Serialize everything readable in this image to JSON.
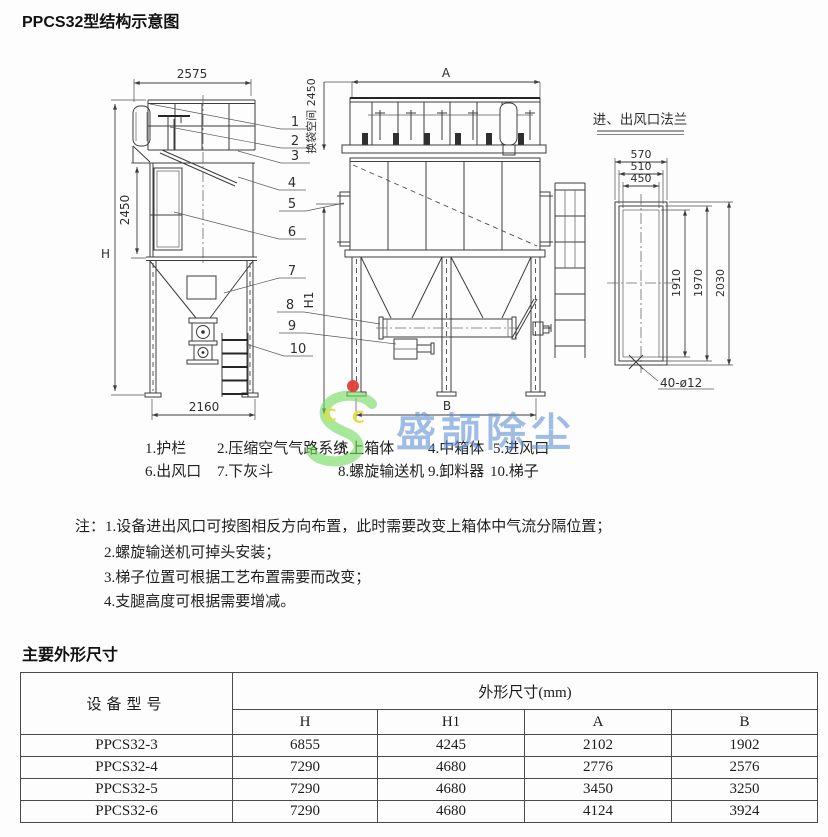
{
  "page": {
    "title": "PPCS32型结构示意图",
    "section2_title": "主要外形尺寸"
  },
  "diagram": {
    "side_view": {
      "dim_top_width": "2575",
      "dim_height": "H",
      "dim_body_height": "2450",
      "dim_bottom_width": "2160"
    },
    "front_view": {
      "dim_top_width": "A",
      "dim_bag_space": "换袋空间 2450",
      "dim_inlet_height": "H1",
      "dim_bottom_width": "B"
    },
    "flange_view": {
      "title": "进、出风口法兰",
      "dim_w_outer": "570",
      "dim_w_mid": "510",
      "dim_w_inner": "450",
      "dim_h_inner": "1910",
      "dim_h_mid": "1970",
      "dim_h_outer": "2030",
      "bolt_note": "40-ø12"
    },
    "callouts": [
      "1",
      "2",
      "3",
      "4",
      "5",
      "6",
      "7",
      "8",
      "9",
      "10"
    ]
  },
  "legend": {
    "items": [
      "1.护栏",
      "2.压缩空气气路系统",
      "3.上箱体",
      "4.中箱体",
      "5.进风口",
      "6.出风口",
      "7.下灰斗",
      "8.螺旋输送机",
      "9.卸料器",
      "10.梯子"
    ]
  },
  "notes": {
    "prefix": "注：",
    "items": [
      "1.设备进出风口可按图相反方向布置，此时需要改变上箱体中气流分隔位置；",
      "2.螺旋输送机可掉头安装；",
      "3.梯子位置可根据工艺布置需要而改变；",
      "4.支腿高度可根据需要增减。"
    ]
  },
  "watermark": {
    "text": "盛颉除尘",
    "c1": "C",
    "c2": "C",
    "green": "#72db5f",
    "blue": "#6291d6",
    "yellow": "#e8dc43",
    "red": "#e23b32"
  },
  "table": {
    "header": {
      "model_col": "设备型号",
      "dims_col": "外形尺寸(mm)",
      "sub": [
        "H",
        "H1",
        "A",
        "B"
      ]
    },
    "rows": [
      {
        "model": "PPCS32-3",
        "values": [
          "6855",
          "4245",
          "2102",
          "1902"
        ]
      },
      {
        "model": "PPCS32-4",
        "values": [
          "7290",
          "4680",
          "2776",
          "2576"
        ]
      },
      {
        "model": "PPCS32-5",
        "values": [
          "7290",
          "4680",
          "3450",
          "3250"
        ]
      },
      {
        "model": "PPCS32-6",
        "values": [
          "7290",
          "4680",
          "4124",
          "3924"
        ]
      }
    ]
  }
}
